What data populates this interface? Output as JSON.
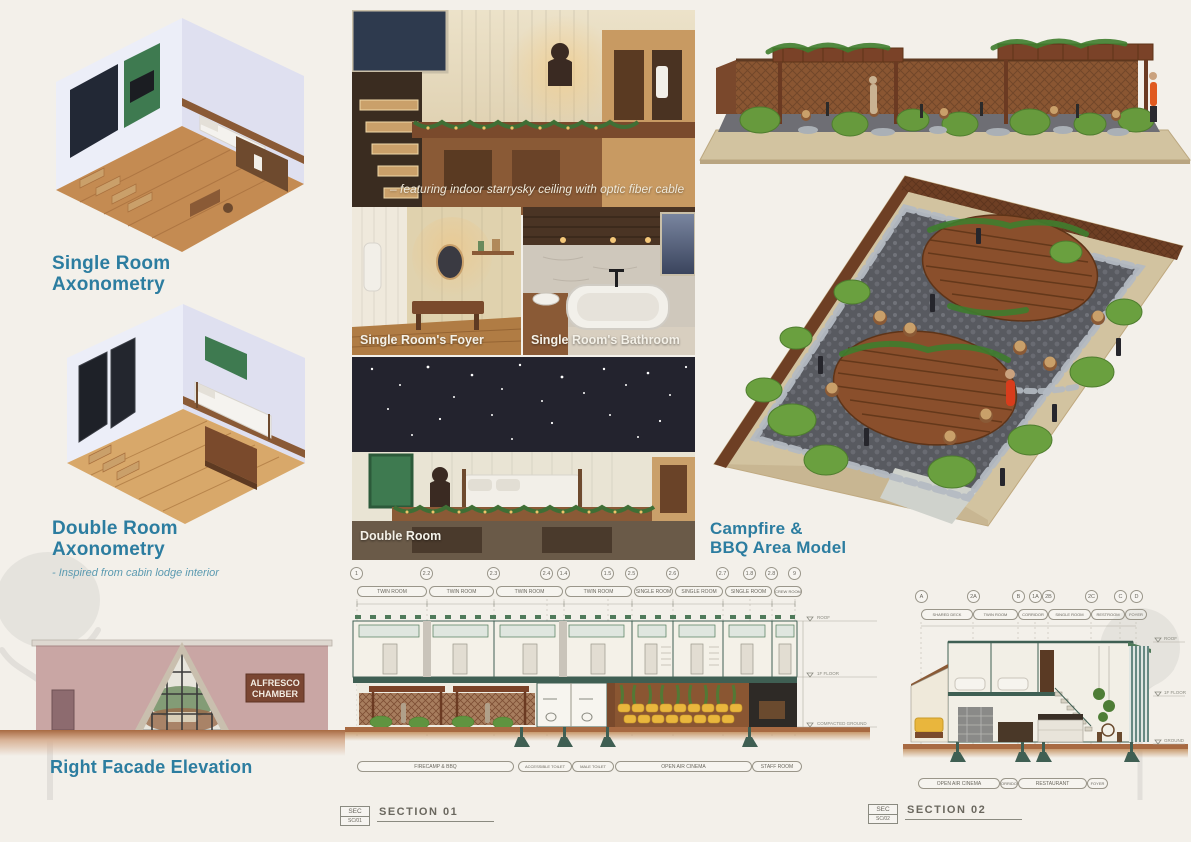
{
  "page": {
    "background": "#f3f0ea",
    "accent_teal": "#2c7da0"
  },
  "left": {
    "single_title_1": "Single Room",
    "single_title_2": "Axonometry",
    "double_title_1": "Double Room",
    "double_title_2": "Axonometry",
    "double_note": "-  Inspired from cabin lodge interior",
    "facade_title": "Right Facade Elevation",
    "sign_1": "ALFRESCO",
    "sign_2": "CHAMBER"
  },
  "middle": {
    "starry_caption": "–  featuring indoor starrysky ceiling with optic fiber cable",
    "foyer_caption": "Single Room's Foyer",
    "bathroom_caption": "Single Room's Bathroom",
    "double_caption": "Double Room"
  },
  "right": {
    "model_title_1": "Campfire &",
    "model_title_2": "BBQ Area Model"
  },
  "section01": {
    "tag_top": "SEC",
    "tag_no": "SC/01",
    "title": "SECTION 01",
    "bubbles": [
      "1",
      "2.2",
      "2.3",
      "2.4",
      "1.4",
      "1.5",
      "2.5",
      "2.6",
      "2.7",
      "1.8",
      "2.8",
      "9"
    ],
    "rooms_top": [
      "TWIN ROOM",
      "TWIN ROOM",
      "TWIN ROOM",
      "TWIN ROOM",
      "SINGLE ROOM",
      "SINGLE ROOM",
      "SINGLE ROOM",
      "CREW ROOM"
    ],
    "rooms_bottom": [
      "FIRECAMP & BBQ",
      "ACCESSIBLE TOILET",
      "MALE TOILET",
      "OPEN AIR CINEMA",
      "STAFF ROOM"
    ],
    "levels": [
      "ROOF",
      "1F FLOOR",
      "COMPACTED GROUND"
    ]
  },
  "section02": {
    "tag_top": "SEC",
    "tag_no": "SC/02",
    "title": "SECTION 02",
    "bubbles": [
      "A",
      "2A",
      "B",
      "1A",
      "2B",
      "2C",
      "C",
      "D"
    ],
    "rooms_top": [
      "SHARED DECK",
      "TWIN ROOM",
      "CORRIDOR",
      "SINGLE ROOM",
      "RESTROOM",
      "FOYER"
    ],
    "rooms_bottom": [
      "OPEN AIR CINEMA",
      "CORRIDOR",
      "RESTAURANT",
      "FOYER"
    ],
    "levels": [
      "ROOF",
      "1F FLOOR",
      "GROUND"
    ]
  },
  "colors": {
    "drawing_green": "#3f5f53",
    "wood_brown": "#8a5632",
    "ground_brown": "#a86a42",
    "seat_yellow": "#e9b63d",
    "plant_green": "#4e7d36",
    "facade_pink": "#c9a6a4",
    "sign_brown": "#7a4632",
    "model_base_tan": "#d2c3a0",
    "model_green": "#679a3d"
  }
}
